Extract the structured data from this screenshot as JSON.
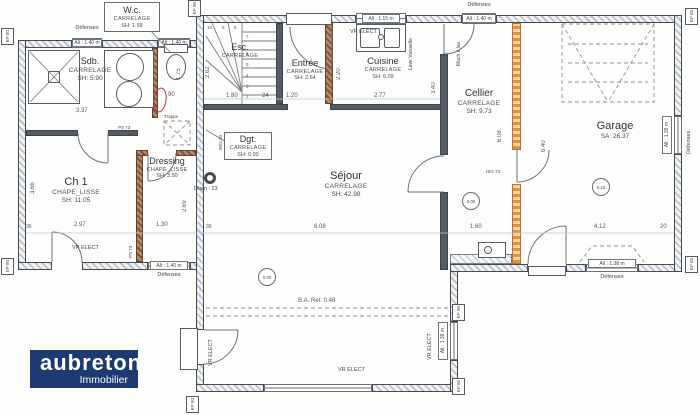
{
  "logo": {
    "name": "aubreton",
    "tagline": "Immobilier",
    "bg": "#1e3a72"
  },
  "rooms": {
    "wc": {
      "name": "W.c.",
      "finish": "CARRELAGE",
      "area": "SH: 1.58"
    },
    "sdb": {
      "name": "Sdb.",
      "finish": "CARRELAGE",
      "area": "SH: 5.90"
    },
    "esc": {
      "name": "Esc.",
      "finish": "CARRELAGE",
      "area": ""
    },
    "entree": {
      "name": "Entrée",
      "finish": "CARRELAGE",
      "area": "SH: 2.64"
    },
    "cuisine": {
      "name": "Cuisine",
      "finish": "CARRELAGE",
      "area": "SH: 6.09"
    },
    "cellier": {
      "name": "Cellier",
      "finish": "CARRELAGE",
      "area": "SH: 9.73"
    },
    "garage": {
      "name": "Garage",
      "area": "SA: 26.37"
    },
    "ch1": {
      "name": "Ch 1",
      "finish": "CHAPE_LISSE",
      "area": "SH: 11.05"
    },
    "dressing": {
      "name": "Dressing",
      "finish": "CHAPE_LISSE",
      "area": "SH: 3.50"
    },
    "dgt": {
      "name": "Dgt.",
      "finish": "CARRELAGE",
      "area": "SH: 0.99"
    },
    "sejour": {
      "name": "Séjour",
      "finish": "CARRELAGE",
      "area": "SH: 42.98"
    }
  },
  "levels": {
    "sejour": "0.00",
    "cellier": "0.00",
    "garage": "0.22"
  },
  "ann": {
    "trappe": "Trappe",
    "diam": "Diam : 23",
    "ba": "B.A. Ret: 0.48",
    "vr": "VR ELECT",
    "lv": "Lave Vaisselle",
    "ml": "Mach à lav.",
    "def": "Défenses",
    "ps73": "PS 73",
    "iso73": "ISO 73",
    "door90": "90/2.10",
    "ep80": "EP 80",
    "alt140": "Alt : 1.40 m",
    "alt115": "Alt : 1.15 m",
    "alt138": "Alt : 1.38 m"
  },
  "dims": {
    "d337": "3.37",
    "d175": "1.75",
    "d90": "90",
    "d262": "2.62",
    "d180": "1.80",
    "d24": "24",
    "d120": "1.20",
    "d220": "2.20",
    "d277": "2.77",
    "d340": "3.40",
    "d366": "3.66",
    "d297": "2.97",
    "d130": "1.30",
    "d269": "2.69",
    "d608": "6.08",
    "d640": "6.40",
    "d160": "1.60",
    "d412": "4.12",
    "d20": "20",
    "d36": "36"
  },
  "stairs": {
    "steps": [
      "10",
      "9",
      "8",
      "7",
      "6",
      "5",
      "4",
      "3",
      "2",
      "1"
    ]
  },
  "colors": {
    "insulation": "#e1913f",
    "wall": "#454b54",
    "logo_bg": "#1e3a72",
    "stamp": "#c23434"
  }
}
